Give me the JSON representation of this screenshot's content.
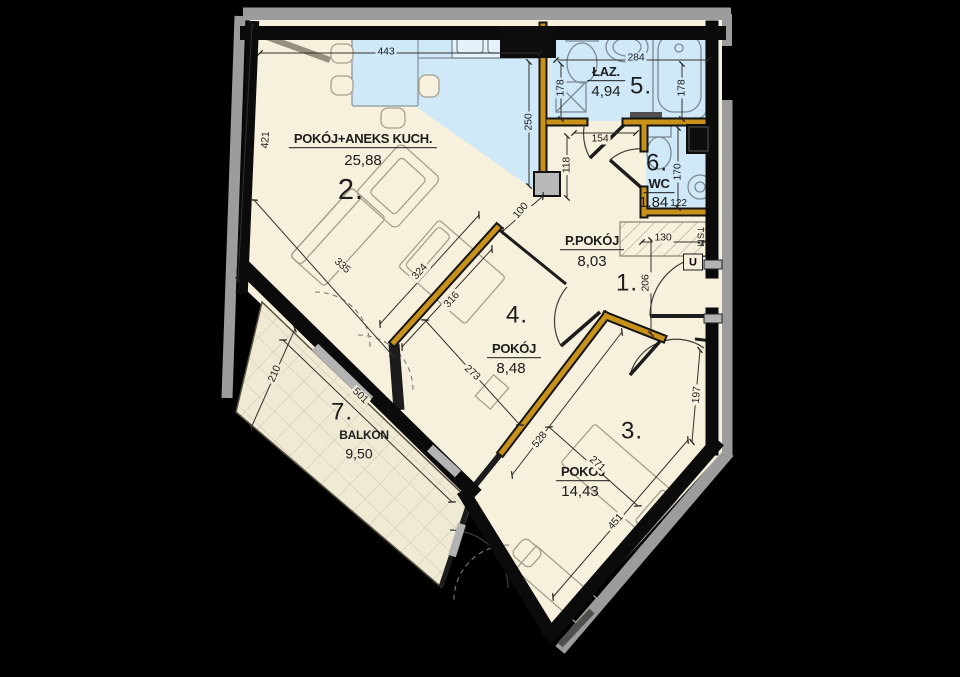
{
  "rooms": {
    "r1": {
      "number": "1.",
      "name": "P.POKÓJ",
      "area": "8,03"
    },
    "r2": {
      "number": "2.",
      "name": "POKÓJ+ANEKS KUCH.",
      "area": "25,88"
    },
    "r3": {
      "number": "3.",
      "name": "POKÓJ",
      "area": "14,43"
    },
    "r4": {
      "number": "4.",
      "name": "POKÓJ",
      "area": "8,48"
    },
    "r5": {
      "number": "5.",
      "name": "ŁAZ.",
      "area": "4,94"
    },
    "r6": {
      "number": "6.",
      "name": "WC",
      "area": "1,84",
      "width_dim": "122"
    },
    "r7": {
      "number": "7.",
      "name": "BALKON",
      "area": "9,50"
    }
  },
  "dims": {
    "top": "443",
    "left": "421",
    "bath_width": "284",
    "bath_left": "178",
    "bath_right": "178",
    "kitchen_depth": "250",
    "nook_width": "154",
    "nook_depth": "118",
    "wc_depth": "170",
    "closet_width": "130",
    "hall_depth": "206",
    "wall_gap": "100",
    "room2_cross": "335",
    "room2_wall": "324",
    "room4_wall": "316",
    "room4_side": "273",
    "room3_wall": "528",
    "room3_cross": "271",
    "room3_side": "451",
    "entry_side": "197",
    "balcony_width": "210",
    "balcony_length": "501"
  },
  "annotations": {
    "shaft": "TSM",
    "utility": "U"
  },
  "colors": {
    "floor": "#f6f0dc",
    "wet_zone": "#cfe9f8",
    "partition_accent": "#c8921a",
    "exterior_wall": "#0b0b0b",
    "shadow_band": "#9c9c9c",
    "balcony_tile": "#f0ead5"
  }
}
